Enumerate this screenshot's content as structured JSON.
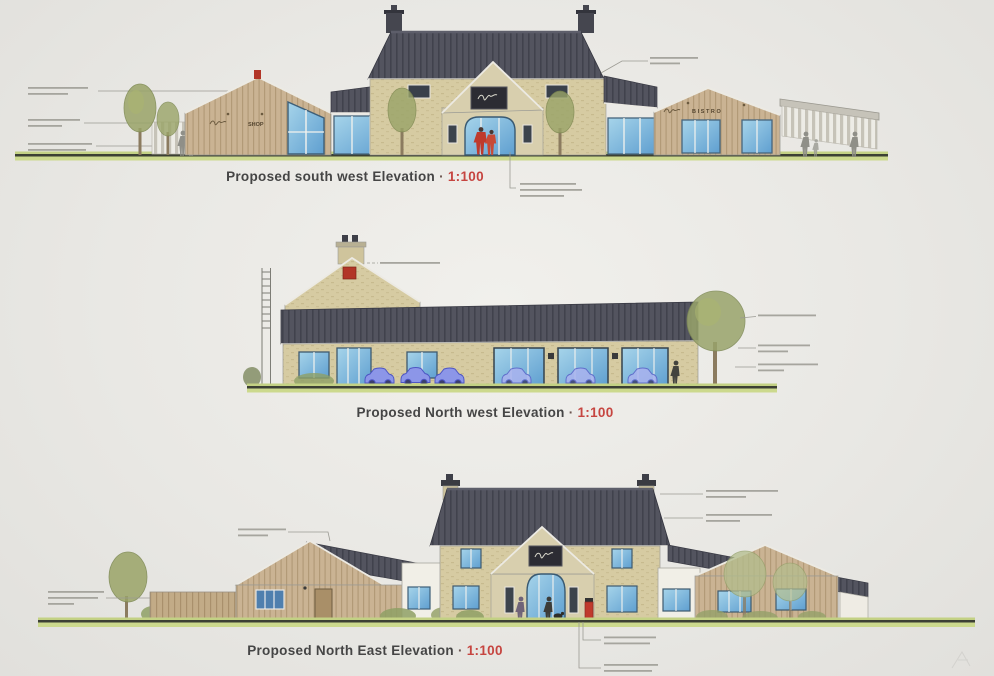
{
  "sheet": {
    "type": "architectural elevations drawing sheet",
    "background_color": "#e9e8e4"
  },
  "elevations": [
    {
      "name": "south-west",
      "title": "Proposed south west Elevation",
      "separator": "·",
      "scale": "1:100",
      "signs": {
        "shop": "SHOP",
        "bistro": "BISTRO"
      },
      "illegible_annotation_notes": 5
    },
    {
      "name": "north-west",
      "title": "Proposed North west Elevation",
      "separator": "·",
      "scale": "1:100",
      "illegible_annotation_notes": 4
    },
    {
      "name": "north-east",
      "title": "Proposed North East Elevation",
      "separator": "·",
      "scale": "1:100",
      "illegible_annotation_notes": 6
    }
  ],
  "palette": {
    "title_text": "#454545",
    "scale_red": "#c64540",
    "roof_slate": "#53545f",
    "stone_wall": "#d6cba2",
    "timber_cladding": "#cab393",
    "glazing_blue": "#7fb9dd",
    "ground_green": "#ccd88d",
    "accent_red": "#bf3a2c",
    "car_blue": "#6a73d6",
    "tree_green": "#9aa468",
    "annotation_gray": "#a6a59e"
  }
}
